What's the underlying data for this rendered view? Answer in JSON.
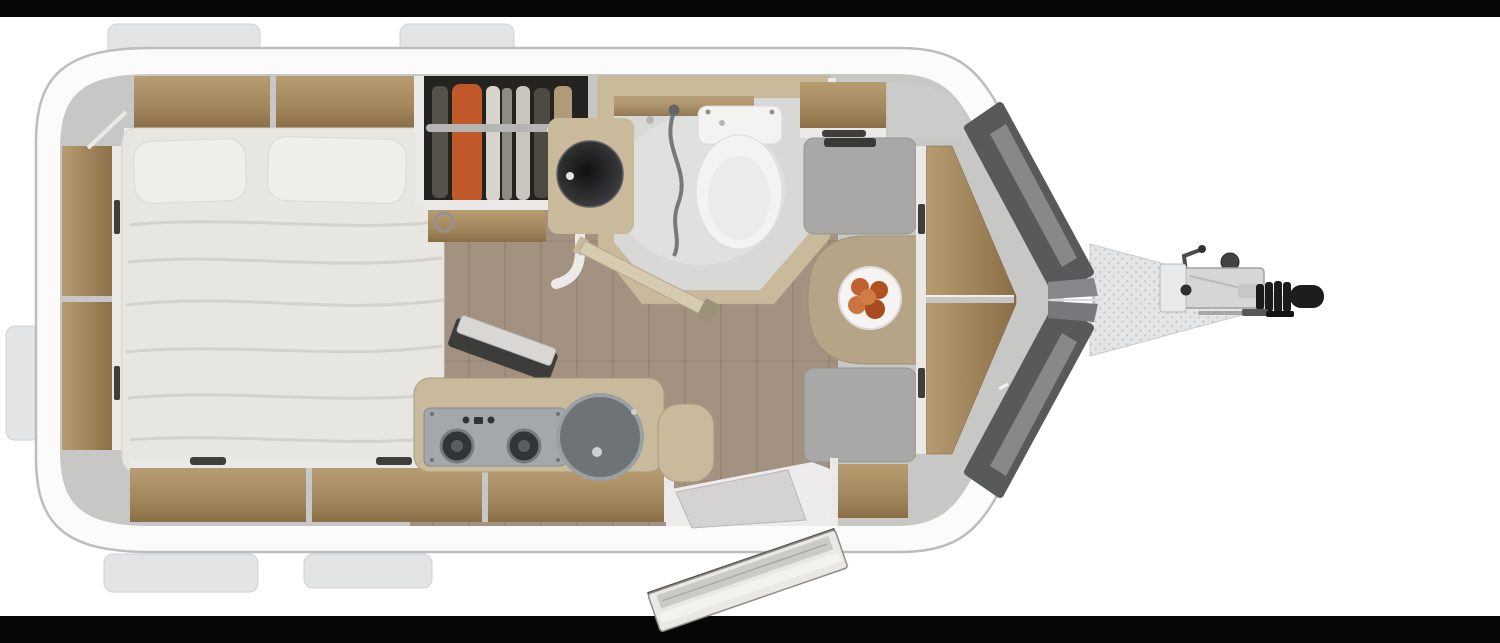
{
  "scene": {
    "width": 1500,
    "height": 643,
    "kind": "travel-trailer-floorplan",
    "view": "top-down 3D rendered floor plan, hitch pointing right"
  },
  "letterbox": {
    "top_bar": true,
    "bottom_bar": true
  },
  "palette": {
    "bg": "#ffffff",
    "bar": "#060606",
    "shell": "#fbfbfb",
    "shellEdge": "#bcbdbe",
    "wallBase": "#c7c7c5",
    "edgeWhite": "#eae9e7",
    "wood1": "#b79c71",
    "wood2": "#8a6e46",
    "floorWood": "#a39181",
    "floorLine": "#8c7a6b",
    "bedBase": "#e8e6e1",
    "bedFold": "#d2d0cb",
    "pillow": "#f0eee9",
    "darkHandle": "#3f3e3b",
    "wardrobeDark": "#24231f",
    "orange": "#c2592a",
    "beige": "#c9ba9c",
    "bathFloor": "#d8d8d6",
    "porcelain": "#f3f3f1",
    "cushion": "#a8a8a6",
    "table": "#b6a486",
    "plate": "#f5f4f2",
    "fruit": "#bf6131",
    "metal": "#a4a8aa",
    "burner": "#313539",
    "sink": "#6e7376",
    "sinkRim": "#9aa0a3",
    "nosePanel": "#58595b",
    "noseStripe": "#8f9193",
    "aframe": "#e4e5e7",
    "aframeDot": "#c3c4c6",
    "hitchDark": "#1b1b1b",
    "coupler": "#d5d6d8",
    "tab": "#e3e4e5"
  },
  "exterior": {
    "window_tabs": [
      "top-left",
      "top-center",
      "rear-left-side",
      "bottom-left",
      "bottom-center"
    ],
    "nose_window_panels": 2,
    "hitch_parts": [
      "a-frame-drawbar",
      "jockey-crank",
      "coupler-housing",
      "bellows-cover",
      "hitch-handle",
      "breakaway-rod"
    ]
  },
  "rooms": {
    "bedroom": [
      "overhead-cabinets",
      "side-shelves-rear",
      "island-bed",
      "pillows",
      "under-bed-cabinets",
      "tv-panel"
    ],
    "wardrobe": [
      "hanging-clothes",
      "orange-garment",
      "clothes-rail",
      "lower-shelf",
      "towel-ring"
    ],
    "bathroom": [
      "washbasin",
      "toilet",
      "shower-tray",
      "shower-hose",
      "swing-door"
    ],
    "kitchen": [
      "countertop",
      "two-burner-stove",
      "round-sink",
      "lower-cabinets",
      "wood-floor"
    ],
    "dinette": [
      "bench-seat-front-top",
      "bench-seat-front-bottom",
      "dining-table",
      "fruit-plate",
      "v-front-seatback"
    ],
    "entry": [
      "doorway",
      "open-entry-door",
      "entry-step"
    ]
  }
}
